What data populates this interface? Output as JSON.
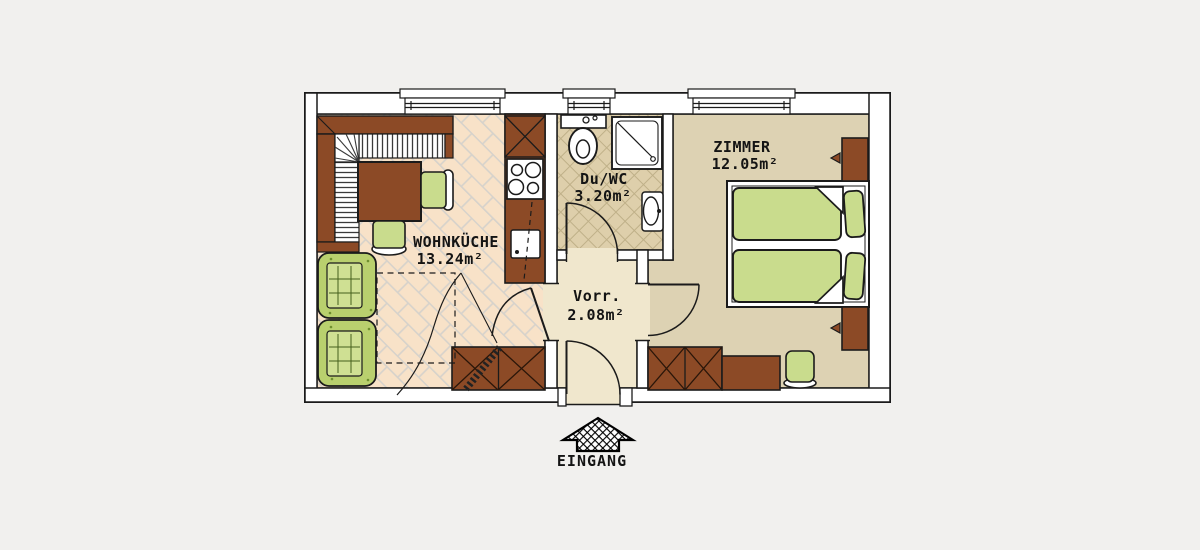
{
  "plan": {
    "rooms": {
      "wohnkueche": {
        "name": "WOHNKÜCHE",
        "area": "13.24m²"
      },
      "du_wc": {
        "name": "Du/WC",
        "area": "3.20m²"
      },
      "vorraum": {
        "name": "Vorr.",
        "area": "2.08m²"
      },
      "zimmer": {
        "name": "ZIMMER",
        "area": "12.05m²"
      }
    },
    "entrance": {
      "label": "EINGANG"
    },
    "colors": {
      "background": "#f1f0ee",
      "wall_fill": "#ffffff",
      "line": "#1b1b1b",
      "wood_brown": "#8c4a26",
      "furniture_green": "#c9dc8d",
      "sofa_green": "#b9d06e",
      "cushion_green": "#cfe093",
      "floor_kitchen_tile": "#f8e2c8",
      "floor_bath": "#decfab",
      "floor_hall": "#f0e7cd",
      "floor_room": "#ddd2b3"
    }
  }
}
